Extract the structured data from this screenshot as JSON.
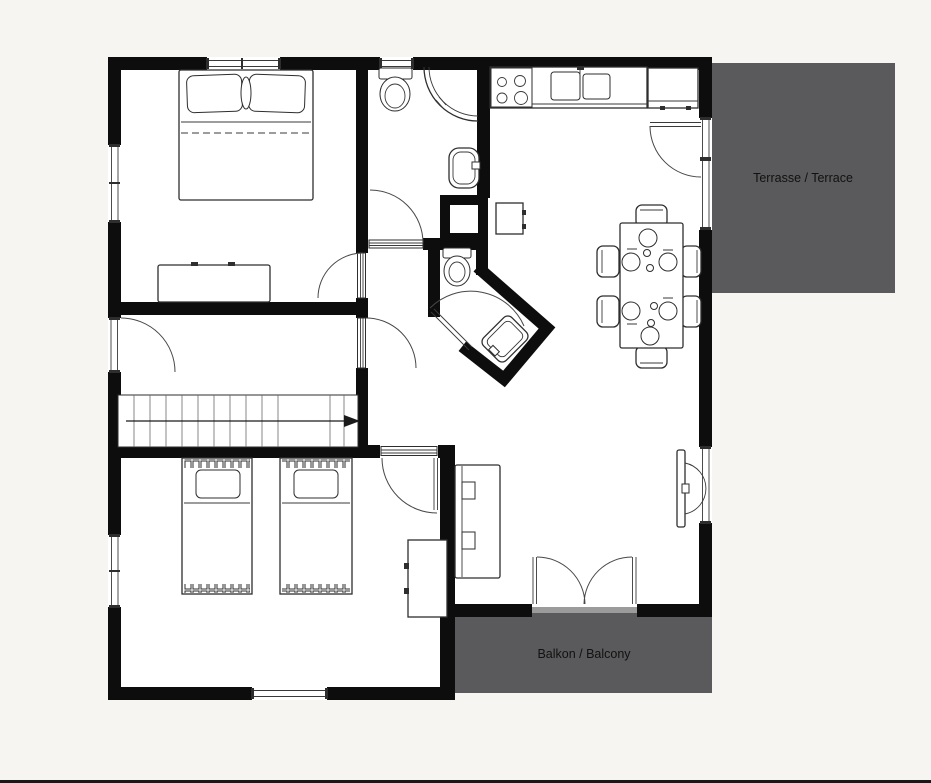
{
  "page": {
    "background_color": "#f6f5f2",
    "bottom_edge_color": "#181818"
  },
  "plan": {
    "type": "floor-plan",
    "colors": {
      "wall": "#0d0d0d",
      "floor": "#ffffff",
      "furniture_line": "#2e2e2e",
      "outdoor_fill": "#5a5a5c",
      "threshold": "#9b9b9b",
      "label_text": "#111111"
    },
    "areas": {
      "terrace": {
        "label": "Terrasse / Terrace",
        "fill": "#5a5a5c"
      },
      "balcony": {
        "label": "Balkon / Balcony",
        "fill": "#5a5a5c"
      }
    }
  }
}
